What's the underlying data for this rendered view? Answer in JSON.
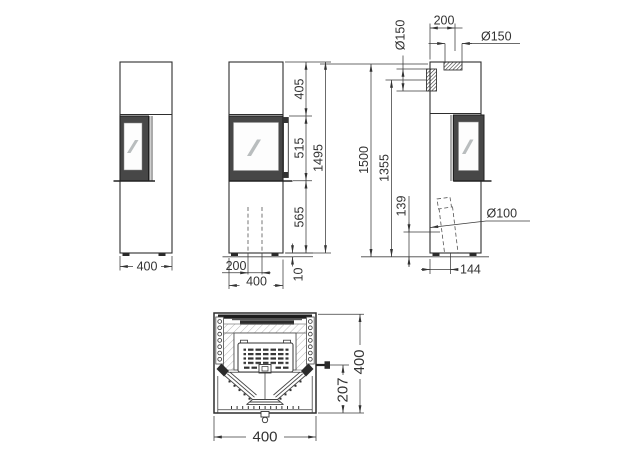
{
  "dimensions": {
    "left_view": {
      "width": "400"
    },
    "front_view": {
      "top_section_height": "405",
      "door_section_height": "515",
      "base_section_height": "565",
      "overall_height": "1495",
      "channel_width": "200",
      "body_width": "400",
      "plinth_height": "10"
    },
    "side_view": {
      "overall_height": "1500",
      "rear_flue_center_height": "1355",
      "air_inlet_center_height": "139",
      "top_flue_center_offset": "200",
      "top_flue_diameter": "Ø150",
      "rear_flue_diameter": "Ø150",
      "air_inlet_diameter": "Ø100",
      "air_inlet_center_offset": "144"
    },
    "plan_view": {
      "body_width": "400",
      "body_depth": "400",
      "handle_depth": "207"
    }
  }
}
